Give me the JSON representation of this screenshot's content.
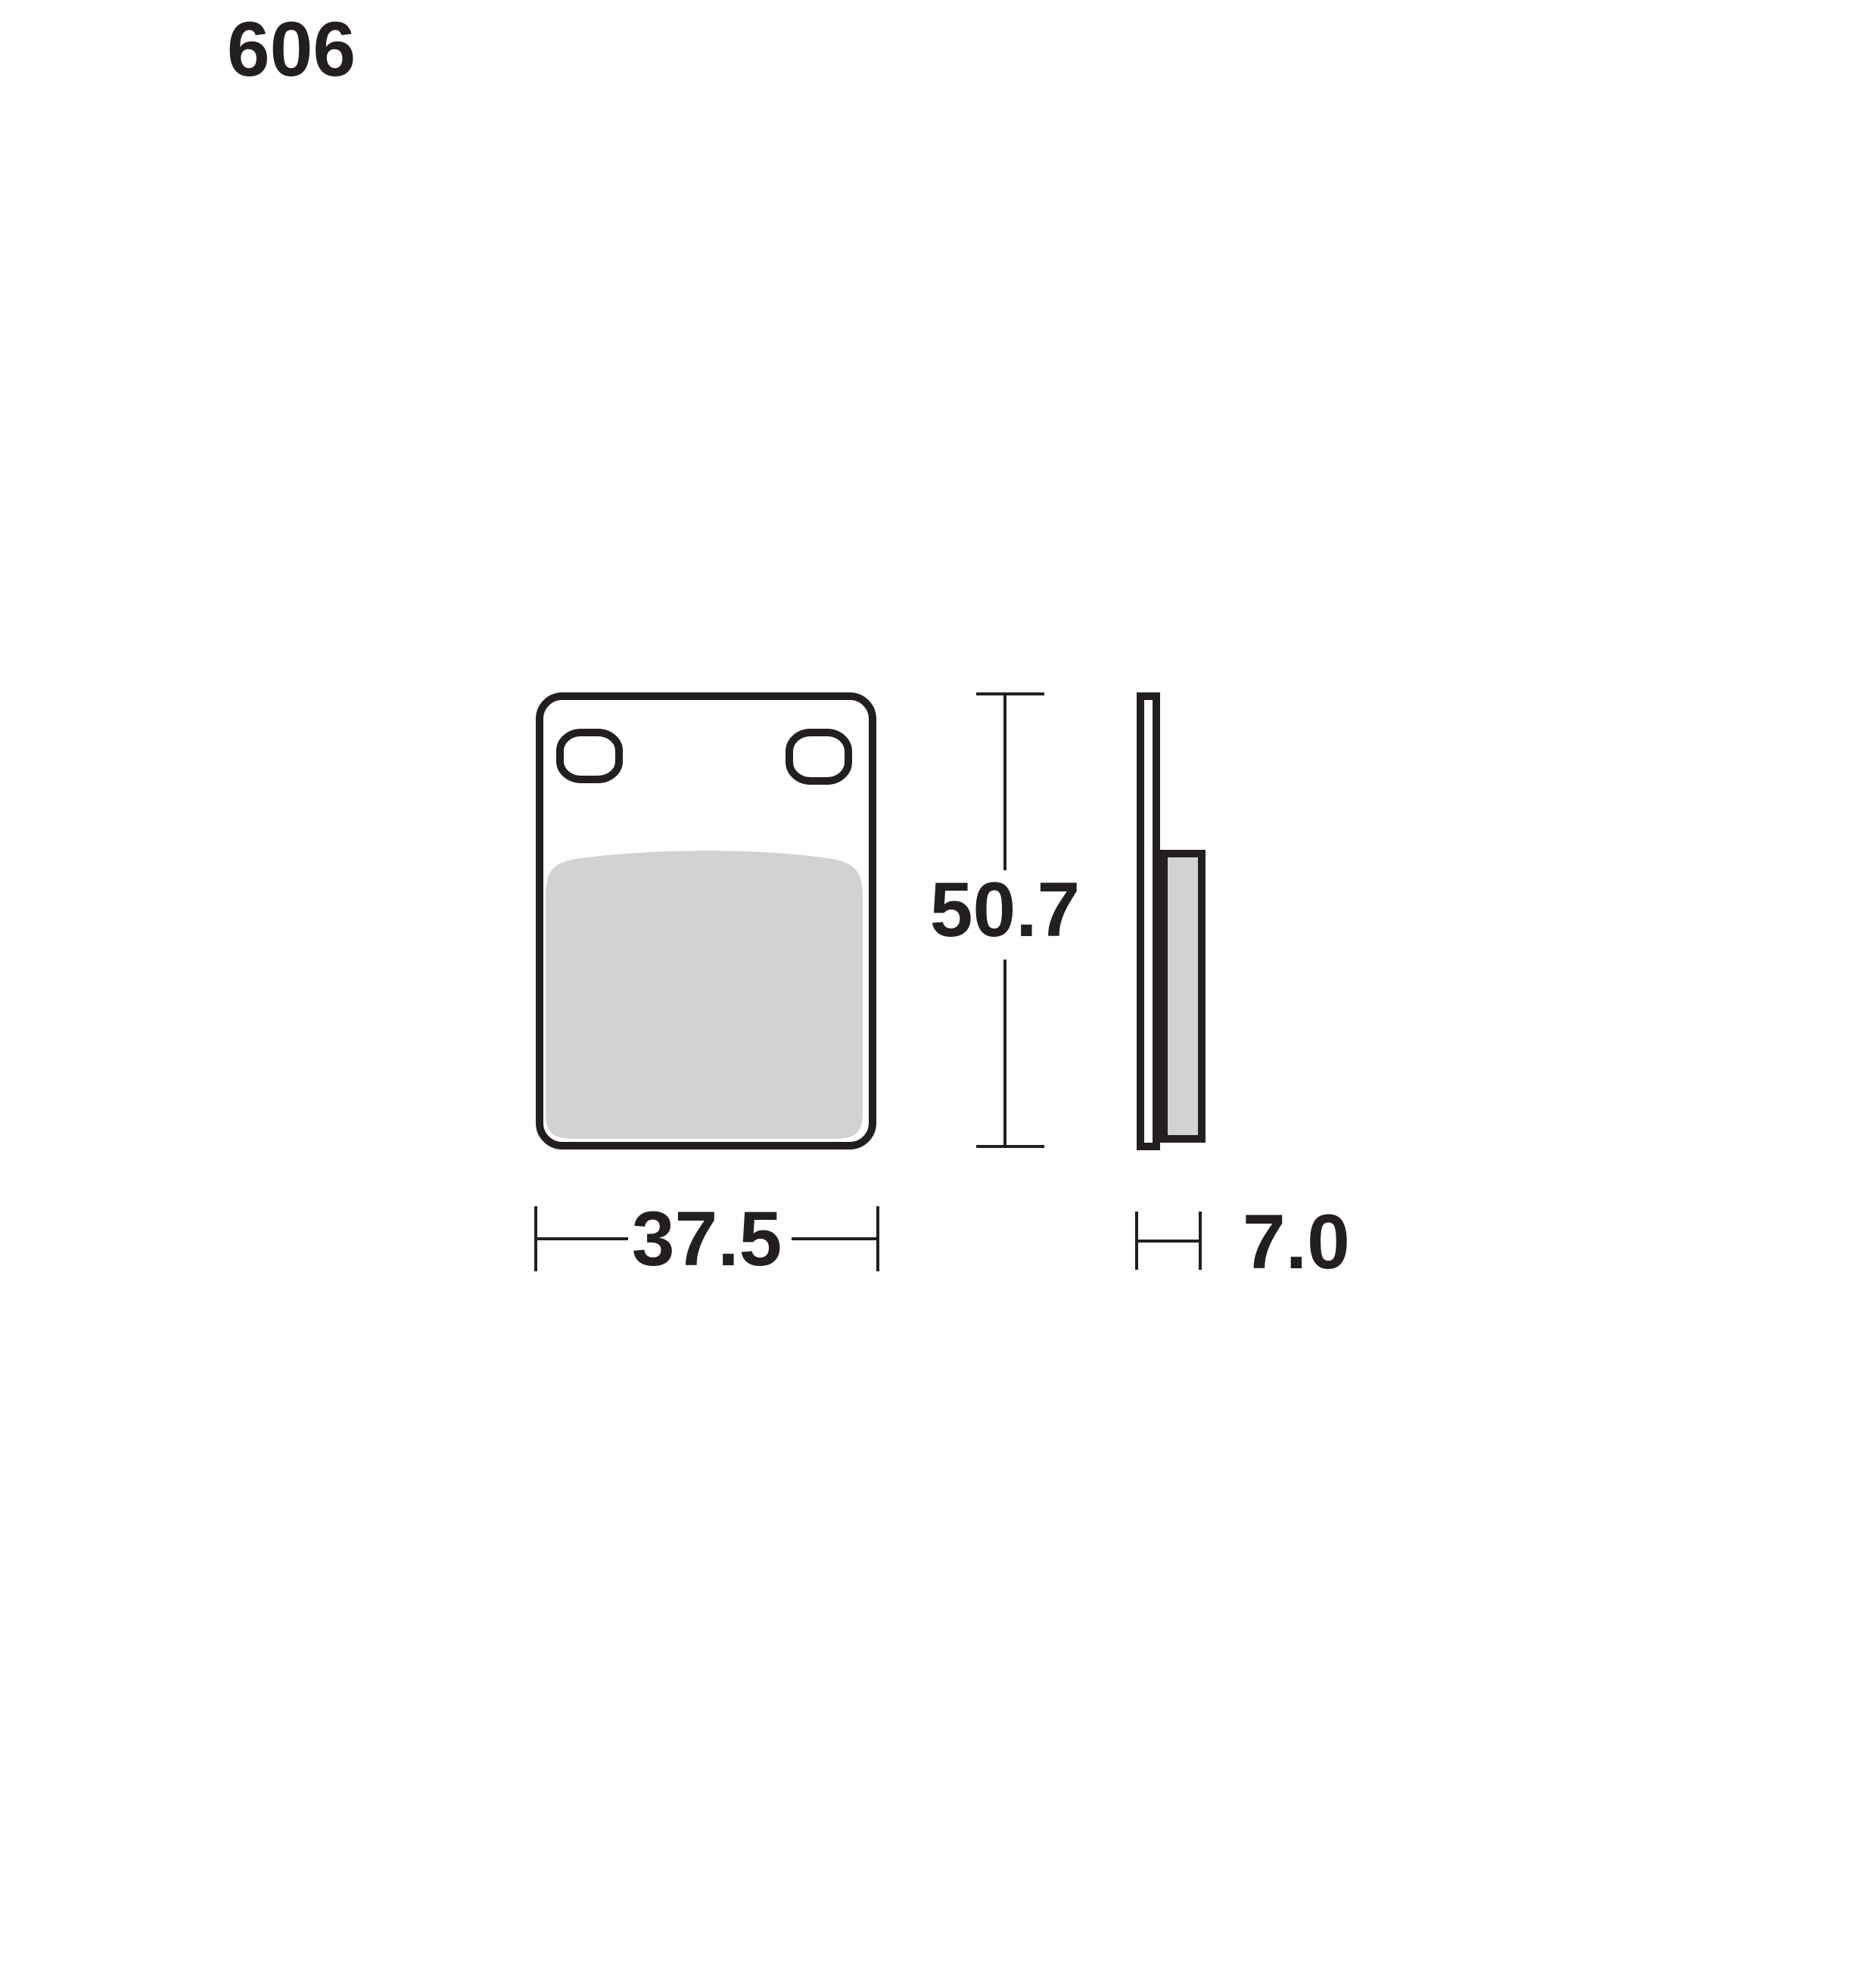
{
  "part_number": "606",
  "dimensions": {
    "height_mm": "50.7",
    "width_mm": "37.5",
    "thickness_mm": "7.0"
  },
  "colors": {
    "ink": "#231f20",
    "friction_gray": "#d1d2d4",
    "background": "#ffffff"
  }
}
